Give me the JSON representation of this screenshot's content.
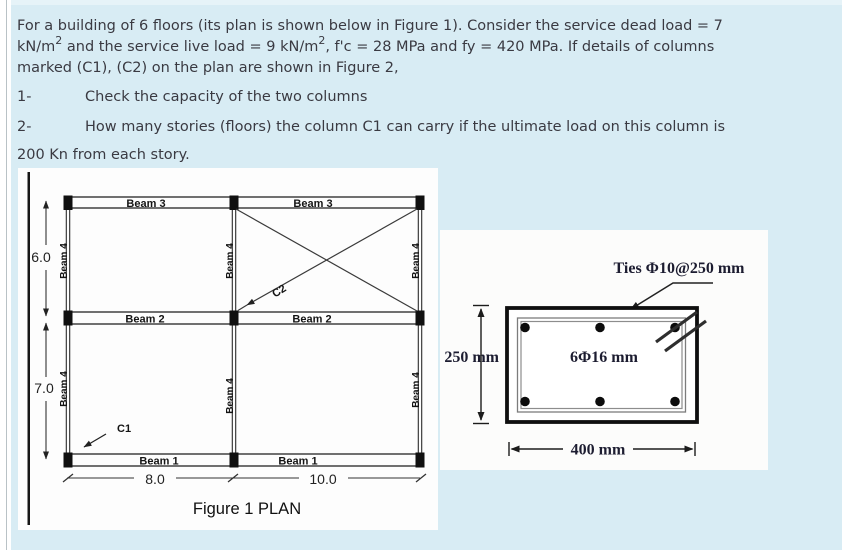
{
  "colors": {
    "page_bg": "#ffffff",
    "content_bg": "#d8ecf4",
    "figure_bg": "#fdfdfd",
    "drawing_ink": "#1a1a1a",
    "body_text": "#3a3a42",
    "serif_ink": "#1c1c30"
  },
  "problem": {
    "line1": "For a building of 6 floors (its plan is shown below in Figure 1). Consider the service dead load = 7",
    "line2_a": "kN/m",
    "line2_sup1": "2",
    "line2_b": " and the service live load = 9 kN/m",
    "line2_sup2": "2",
    "line2_c": ", f'c = 28 MPa and fy = 420 MPa. If details of columns",
    "line3": "marked (C1), (C2) on the plan are shown in Figure 2,",
    "item1_num": "1-",
    "item1_text": "Check the capacity of the two columns",
    "item2_num": "2-",
    "item2_text": "How many stories (floors) the column C1 can carry if the ultimate load on this column is",
    "item2_cont": "200 Kn from each story."
  },
  "figure1": {
    "caption": "Figure 1 PLAN",
    "beam1": "Beam 1",
    "beam2": "Beam 2",
    "beam3": "Beam 3",
    "beam4": "Beam 4",
    "col1": "C1",
    "col2": "C2",
    "dim_left_top": "6.0",
    "dim_left_bottom": "7.0",
    "dim_bottom_left": "8.0",
    "dim_bottom_right": "10.0"
  },
  "figure2": {
    "ties_label": "Ties Φ10@250 mm",
    "bars_label": "6Φ16 mm",
    "height_label": "250 mm",
    "width_label": "400 mm"
  }
}
